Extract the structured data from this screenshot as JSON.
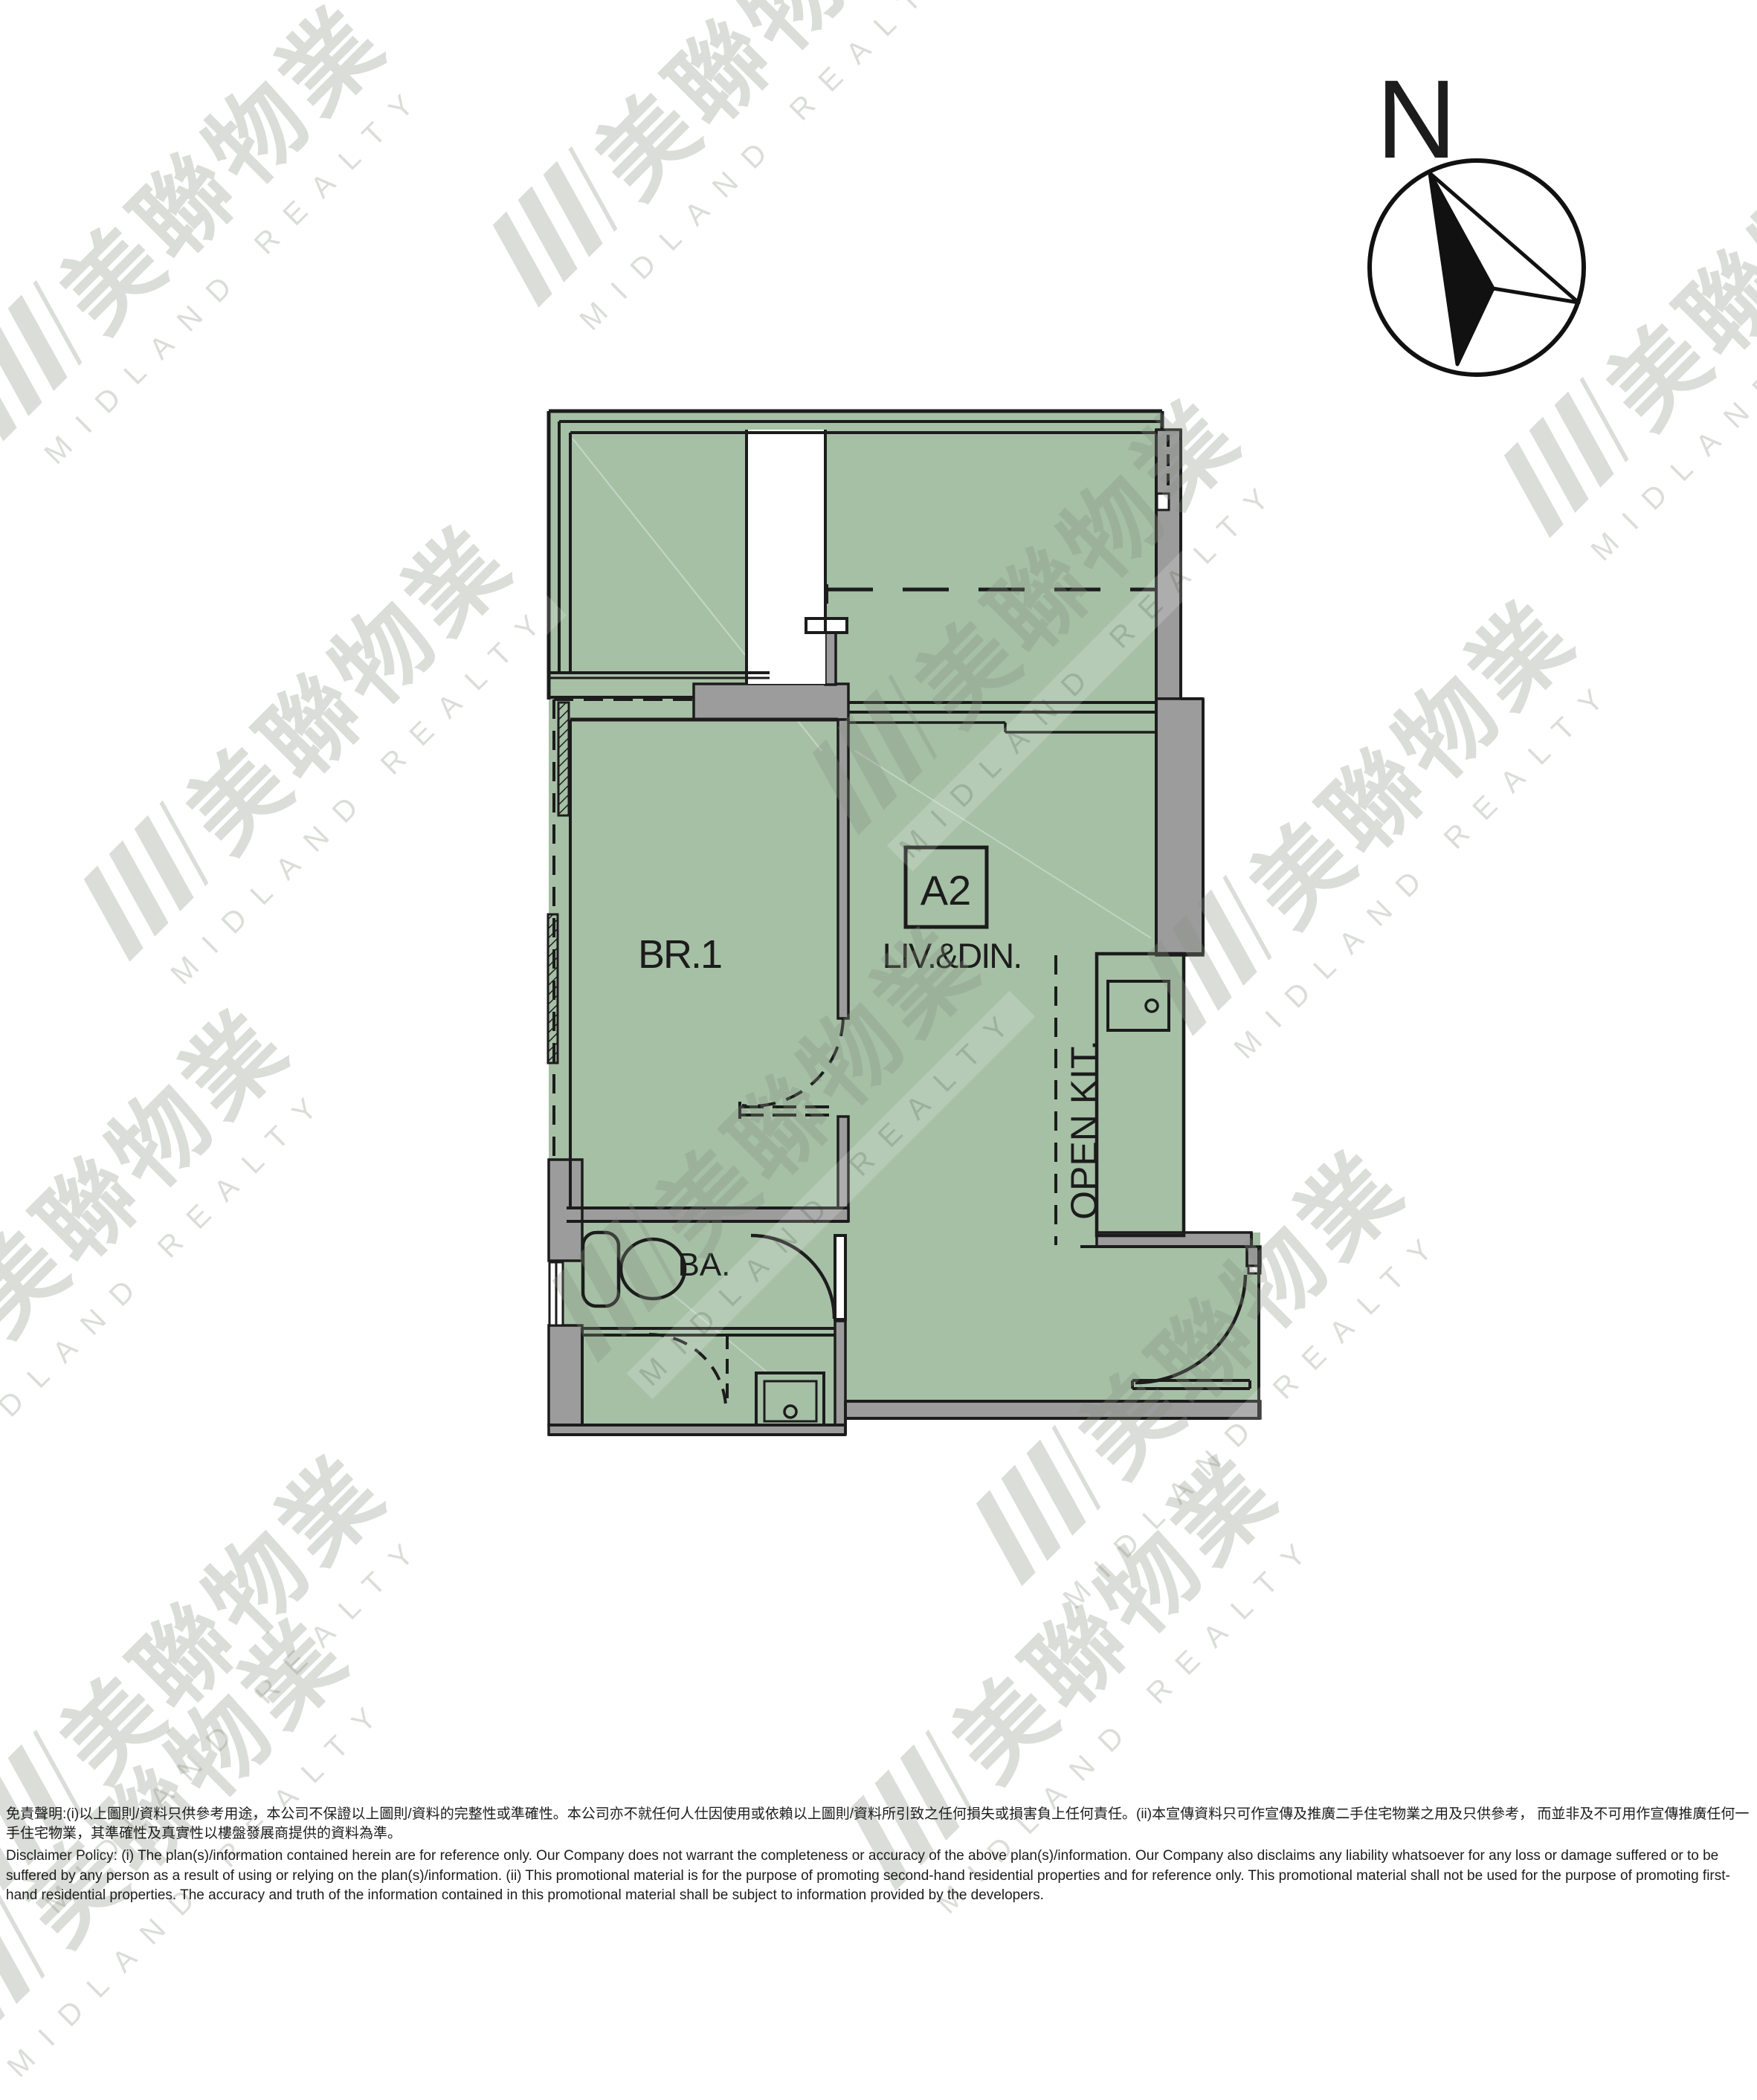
{
  "plan": {
    "unit_label": "A2",
    "rooms": {
      "bedroom": "BR.1",
      "living_dining": "LIV.&DIN.",
      "open_kitchen": "OPEN KIT.",
      "bathroom": "BA."
    },
    "compass_label": "N"
  },
  "watermark": {
    "cjk": "美聯物業",
    "en": "MIDLAND REALTY"
  },
  "colors": {
    "floor_green": "#a6c0a6",
    "wall_grey": "#9c9c9c",
    "line_black": "#1c1c1c"
  },
  "disclaimer": {
    "zh": "免責聲明:(i)以上圖則/資料只供參考用途，本公司不保證以上圖則/資料的完整性或準確性。本公司亦不就任何人仕因使用或依賴以上圖則/資料所引致之任何損失或損害負上任何責任。(ii)本宣傳資料只可作宣傳及推廣二手住宅物業之用及只供參考， 而並非及不可用作宣傳推廣任何一手住宅物業，其準確性及真實性以樓盤發展商提供的資料為準。",
    "en": "Disclaimer Policy: (i) The plan(s)/information contained herein are for reference only. Our Company does not warrant the completeness or accuracy of the above plan(s)/information. Our Company also disclaims any liability whatsoever for any loss or damage suffered or to be suffered by any person as a result of using or relying on the plan(s)/information. (ii) This promotional material is for the purpose of promoting second-hand residential properties and for reference only. This promotional material shall not be used for the purpose of promoting first-hand residential properties. The accuracy and truth of the information contained in this promotional material shall be subject to information provided by the developers."
  }
}
